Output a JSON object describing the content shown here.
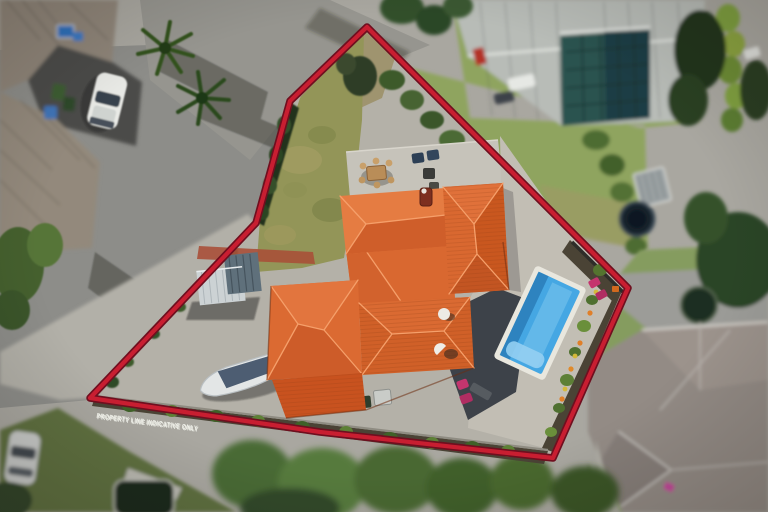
{
  "scene": {
    "type": "aerial-drone-photograph",
    "subject": "residential property with terracotta-roof house, swimming pool and red indicative boundary overlay"
  },
  "boundary": {
    "label": "PROPERTY LINE INDICATIVE ONLY",
    "vertices": "367,27 290,101 256,223 90,398 320,432 553,458 628,288",
    "line_color": "#c81e31",
    "edge_color": "#6f0f1f"
  },
  "colors": {
    "roof_orange": "#d96830",
    "roof_highlight": "#e57c42",
    "roof_shadow": "#c2531f",
    "pool_water": "#45a7e3",
    "pool_coping": "#e9e7de",
    "concrete": "#b4b1a8",
    "asphalt": "#8d8d89",
    "lawn_inside": "#939558",
    "neighbor_lawn": "#859c5e",
    "garden_mulch": "#4a4335",
    "tree_green": "#3c5a2c",
    "carport_light": "#ccd2d4",
    "carport_dark": "#5f707b",
    "boat_hull": "#e3e6e6"
  },
  "features": [
    "main-house-terracotta-roof",
    "chimney",
    "satellite-dishes",
    "patio-with-outdoor-table",
    "carport",
    "boat-on-trailer",
    "swimming-pool",
    "pool-deck",
    "garden-beds-with-flowers",
    "sun-loungers",
    "front-lawn",
    "boundary-hedge",
    "neighbor-house-left",
    "neighbor-house-top-right",
    "neighbor-house-bottom-right",
    "palm-trees",
    "white-car",
    "silver-car",
    "street",
    "spa-pool",
    "garden-shed",
    "trees"
  ]
}
